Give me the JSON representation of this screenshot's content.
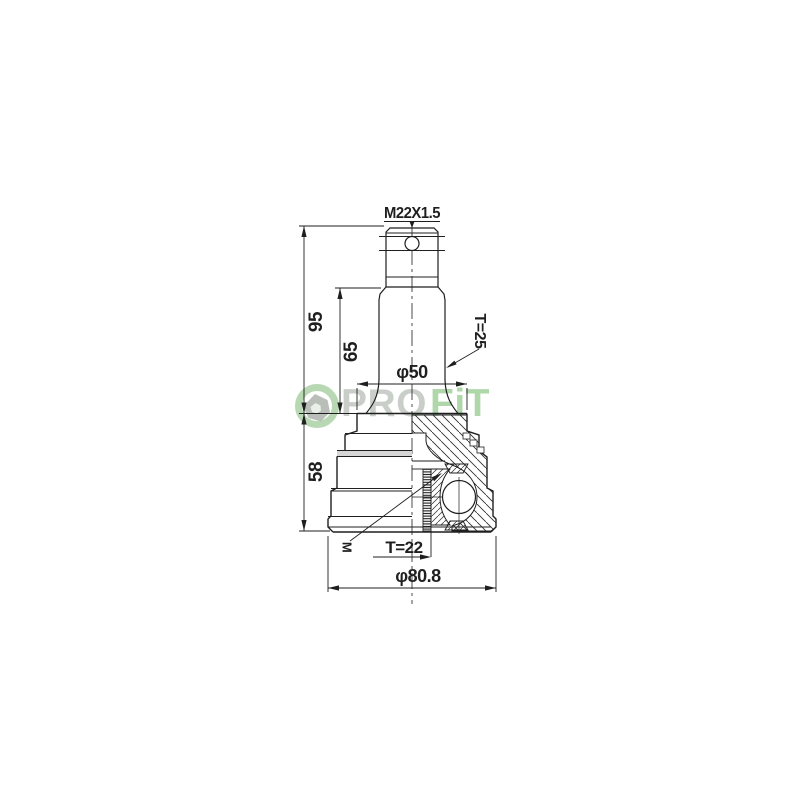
{
  "page": {
    "background_color": "#ffffff"
  },
  "watermark": {
    "text_pro": "PRO",
    "text_fit": "FiT",
    "pro_color": "#c7ccc7",
    "fit_color": "#abd5a6",
    "ring_color": "#b4d6ae",
    "hex_color": "#b6bbb6"
  },
  "drawing": {
    "line_color": "#1f1f1f",
    "band_color": "#d6d6d6",
    "labels": {
      "thread": "M22X1.5",
      "overall_length": "95",
      "shaft_length": "65",
      "shaft_diameter": "φ50",
      "outer_spline_teeth": "T=25",
      "body_length": "58",
      "inner_spline_teeth": "T=22",
      "body_diameter": "φ80.8",
      "inner_spline_mark": "M"
    }
  }
}
